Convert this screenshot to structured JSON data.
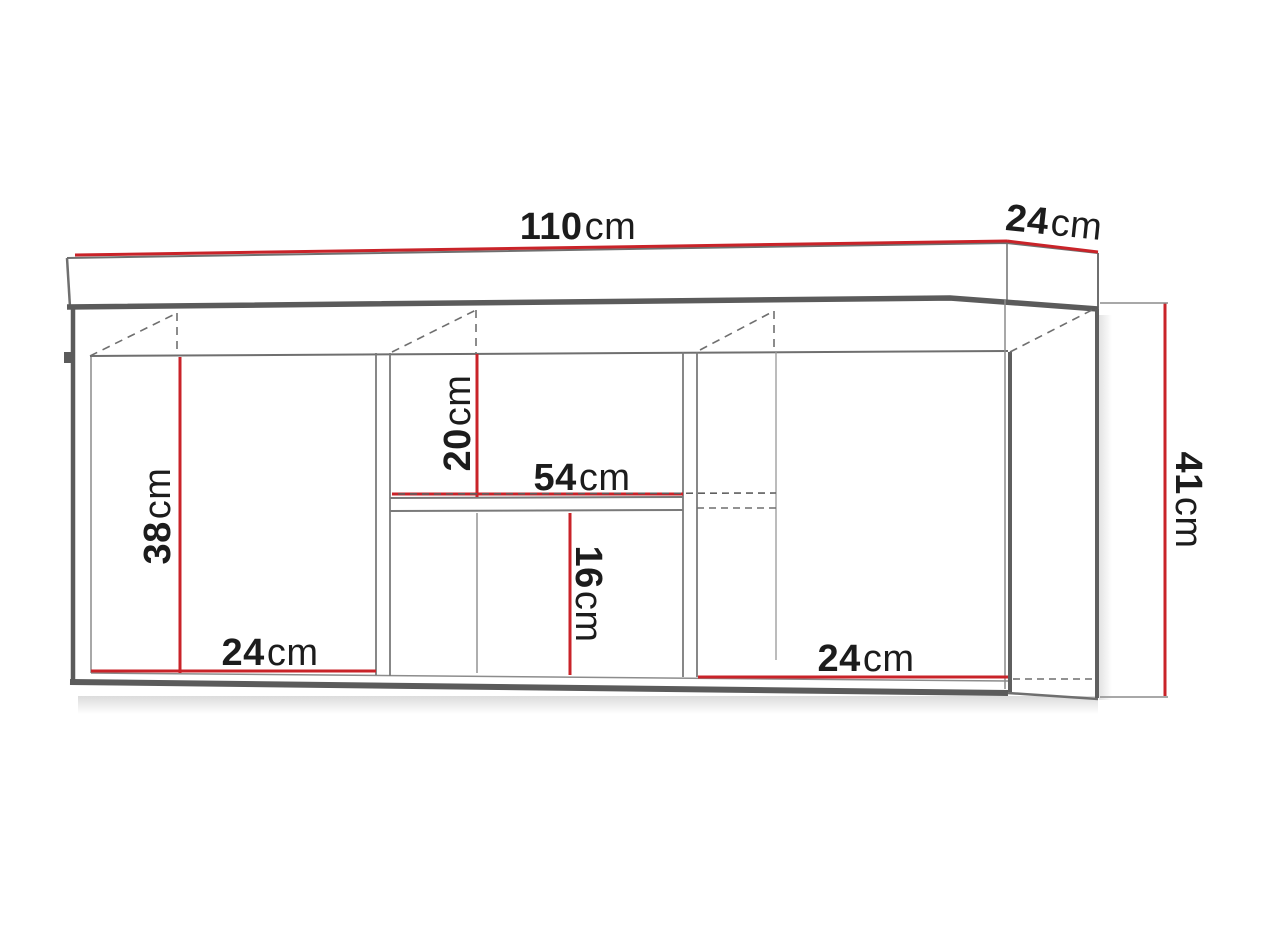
{
  "diagram": {
    "unit": "cm",
    "colors": {
      "dimension_line": "#c92329",
      "outline_dark": "#5b5b5b",
      "outline_light": "#8c8c8c",
      "label_text": "#1c1c1c"
    },
    "dimensions": {
      "total_width": {
        "value": "110",
        "unit": "cm"
      },
      "top_depth": {
        "value": "24",
        "unit": "cm"
      },
      "side_height": {
        "value": "41",
        "unit": "cm"
      },
      "left_compartment_height": {
        "value": "38",
        "unit": "cm"
      },
      "left_compartment_width": {
        "value": "24",
        "unit": "cm"
      },
      "middle_upper_height": {
        "value": "20",
        "unit": "cm"
      },
      "middle_shelf_width": {
        "value": "54",
        "unit": "cm"
      },
      "middle_lower_height": {
        "value": "16",
        "unit": "cm"
      },
      "right_compartment_width": {
        "value": "24",
        "unit": "cm"
      }
    }
  }
}
